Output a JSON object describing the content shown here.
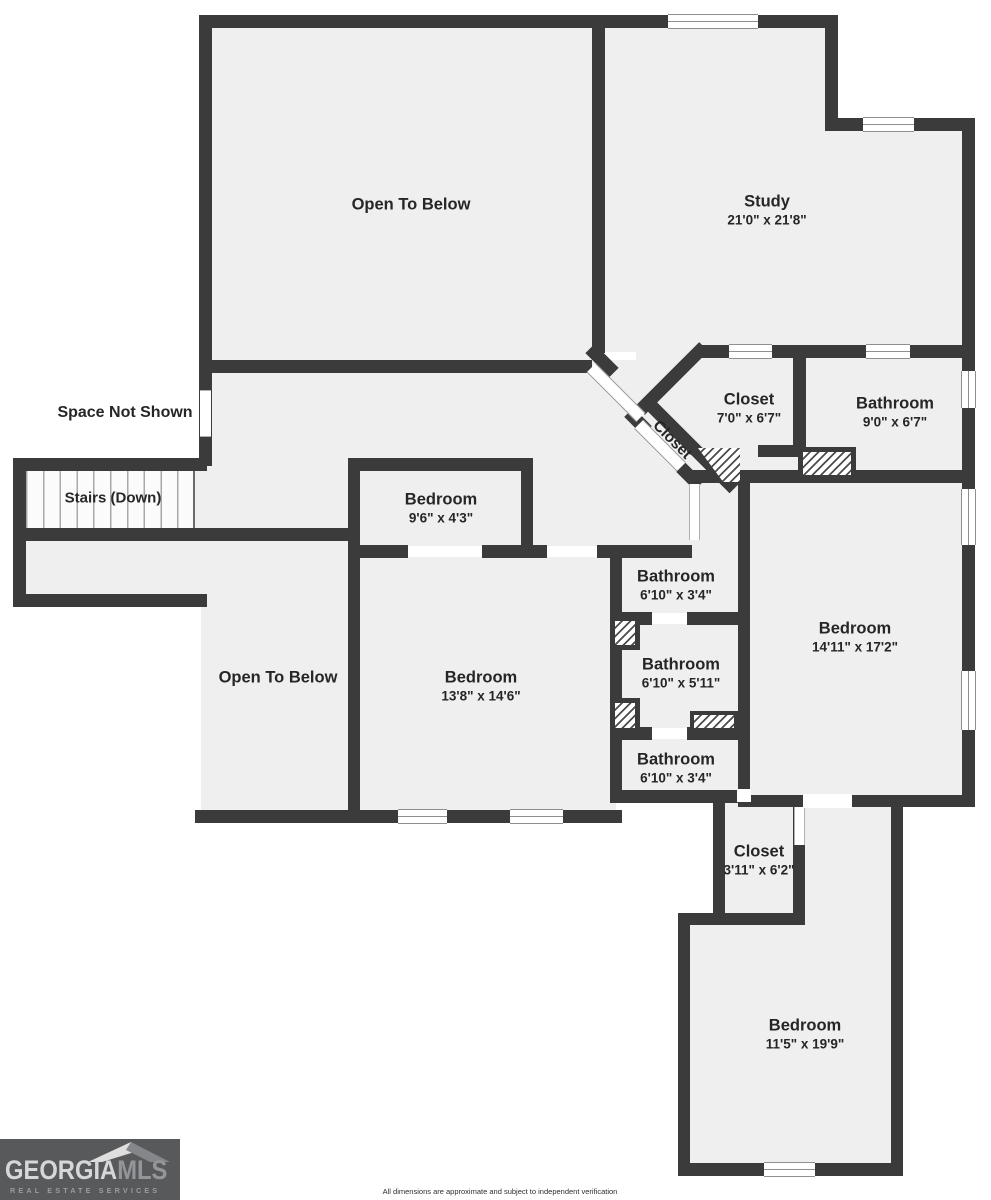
{
  "rooms": {
    "open_below_top": {
      "name": "Open To Below"
    },
    "study": {
      "name": "Study",
      "dims": "21'0\" x 21'8\""
    },
    "closet_main": {
      "name": "Closet",
      "dims": "7'0\" x 6'7\""
    },
    "closet_hall": {
      "name": "Closet"
    },
    "bathroom_top": {
      "name": "Bathroom",
      "dims": "9'0\" x 6'7\""
    },
    "bedroom_small": {
      "name": "Bedroom",
      "dims": "9'6\" x 4'3\""
    },
    "bathroom_a": {
      "name": "Bathroom",
      "dims": "6'10\" x 3'4\""
    },
    "bathroom_b": {
      "name": "Bathroom",
      "dims": "6'10\" x 5'11\""
    },
    "bathroom_c": {
      "name": "Bathroom",
      "dims": "6'10\" x 3'4\""
    },
    "open_below_bottom": {
      "name": "Open To Below"
    },
    "bedroom_mid": {
      "name": "Bedroom",
      "dims": "13'8\" x 14'6\""
    },
    "bedroom_right": {
      "name": "Bedroom",
      "dims": "14'11\" x 17'2\""
    },
    "closet_bottom": {
      "name": "Closet",
      "dims": "3'11\" x 6'2\""
    },
    "bedroom_bottom": {
      "name": "Bedroom",
      "dims": "11'5\" x 19'9\""
    }
  },
  "annotations": {
    "space_not_shown": "Space Not Shown",
    "stairs_down": "Stairs (Down)"
  },
  "logo": {
    "brand_primary": "GEORGIA",
    "brand_secondary": "MLS",
    "tagline": "REAL ESTATE SERVICES"
  },
  "footer": {
    "disclaimer": "All dimensions are approximate and subject to independent verification"
  },
  "colors": {
    "wall": "#3b3b3c",
    "floor": "#efefef",
    "logo_background": "#58595b"
  }
}
